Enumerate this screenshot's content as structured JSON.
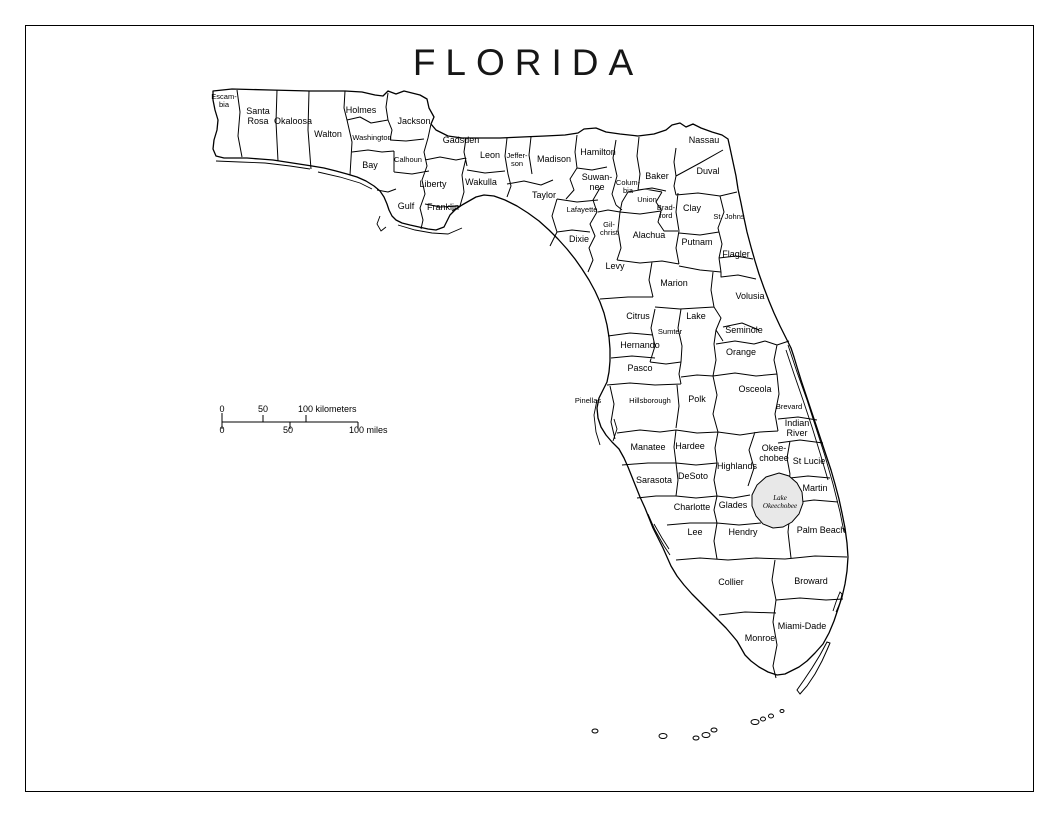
{
  "title": "FLORIDA",
  "scale_bar": {
    "km0": "0",
    "km50": "50",
    "km100": "100 kilometers",
    "mi0": "0",
    "mi50": "50",
    "mi100": "100 miles"
  },
  "lake": {
    "line1": "Lake",
    "line2": "Okeechobee"
  },
  "counties": [
    {
      "name": "Escambia",
      "lines": [
        "Escam-",
        "bia"
      ],
      "x": 224,
      "y": 101,
      "size": "s"
    },
    {
      "name": "Santa Rosa",
      "lines": [
        "Santa",
        "Rosa"
      ],
      "x": 258,
      "y": 117,
      "size": "m"
    },
    {
      "name": "Okaloosa",
      "x": 293,
      "y": 122,
      "size": "m"
    },
    {
      "name": "Walton",
      "x": 328,
      "y": 135,
      "size": "m"
    },
    {
      "name": "Holmes",
      "x": 361,
      "y": 111,
      "size": "m"
    },
    {
      "name": "Washington",
      "x": 372,
      "y": 138,
      "size": "s"
    },
    {
      "name": "Jackson",
      "x": 414,
      "y": 122,
      "size": "m"
    },
    {
      "name": "Bay",
      "x": 370,
      "y": 166,
      "size": "m"
    },
    {
      "name": "Calhoun",
      "x": 408,
      "y": 160,
      "size": "s"
    },
    {
      "name": "Gadsden",
      "x": 461,
      "y": 141,
      "size": "m"
    },
    {
      "name": "Liberty",
      "x": 433,
      "y": 185,
      "size": "m"
    },
    {
      "name": "Gulf",
      "x": 406,
      "y": 207,
      "size": "m"
    },
    {
      "name": "Franklin",
      "x": 443,
      "y": 208,
      "size": "m"
    },
    {
      "name": "Wakulla",
      "x": 481,
      "y": 183,
      "size": "m"
    },
    {
      "name": "Leon",
      "x": 490,
      "y": 156,
      "size": "m"
    },
    {
      "name": "Jefferson",
      "lines": [
        "Jeffer-",
        "son"
      ],
      "x": 517,
      "y": 160,
      "size": "s"
    },
    {
      "name": "Madison",
      "x": 554,
      "y": 160,
      "size": "m"
    },
    {
      "name": "Hamilton",
      "x": 598,
      "y": 153,
      "size": "m"
    },
    {
      "name": "Suwannee",
      "lines": [
        "Suwan-",
        "nee"
      ],
      "x": 597,
      "y": 183,
      "size": "m"
    },
    {
      "name": "Columbia",
      "lines": [
        "Colum-",
        "bia"
      ],
      "x": 628,
      "y": 187,
      "size": "s"
    },
    {
      "name": "Baker",
      "x": 657,
      "y": 177,
      "size": "m"
    },
    {
      "name": "Nassau",
      "x": 704,
      "y": 141,
      "size": "m"
    },
    {
      "name": "Duval",
      "x": 708,
      "y": 172,
      "size": "m"
    },
    {
      "name": "Taylor",
      "x": 544,
      "y": 196,
      "size": "m"
    },
    {
      "name": "Lafayette",
      "x": 582,
      "y": 210,
      "size": "s"
    },
    {
      "name": "Union",
      "x": 647,
      "y": 200,
      "size": "s"
    },
    {
      "name": "Bradford",
      "lines": [
        "Brad-",
        "ford"
      ],
      "x": 666,
      "y": 212,
      "size": "s"
    },
    {
      "name": "Clay",
      "x": 692,
      "y": 209,
      "size": "m"
    },
    {
      "name": "St. Johns",
      "x": 729,
      "y": 217,
      "size": "s"
    },
    {
      "name": "Dixie",
      "x": 579,
      "y": 240,
      "size": "m"
    },
    {
      "name": "Gilchrist",
      "lines": [
        "Gil-",
        "christ"
      ],
      "x": 609,
      "y": 229,
      "size": "s"
    },
    {
      "name": "Alachua",
      "x": 649,
      "y": 236,
      "size": "m"
    },
    {
      "name": "Putnam",
      "x": 697,
      "y": 243,
      "size": "m"
    },
    {
      "name": "Flagler",
      "x": 736,
      "y": 255,
      "size": "m"
    },
    {
      "name": "Levy",
      "x": 615,
      "y": 267,
      "size": "m"
    },
    {
      "name": "Marion",
      "x": 674,
      "y": 284,
      "size": "m"
    },
    {
      "name": "Volusia",
      "x": 750,
      "y": 297,
      "size": "m"
    },
    {
      "name": "Citrus",
      "x": 638,
      "y": 317,
      "size": "m"
    },
    {
      "name": "Lake",
      "x": 696,
      "y": 317,
      "size": "m"
    },
    {
      "name": "Sumter",
      "x": 670,
      "y": 332,
      "size": "s"
    },
    {
      "name": "Seminole",
      "x": 744,
      "y": 331,
      "size": "m"
    },
    {
      "name": "Hernando",
      "x": 640,
      "y": 346,
      "size": "m"
    },
    {
      "name": "Orange",
      "x": 741,
      "y": 353,
      "size": "m"
    },
    {
      "name": "Pasco",
      "x": 640,
      "y": 369,
      "size": "m"
    },
    {
      "name": "Osceola",
      "x": 755,
      "y": 390,
      "size": "m"
    },
    {
      "name": "Pinellas",
      "x": 588,
      "y": 401,
      "size": "s"
    },
    {
      "name": "Hillsborough",
      "x": 650,
      "y": 401,
      "size": "s"
    },
    {
      "name": "Polk",
      "x": 697,
      "y": 400,
      "size": "m"
    },
    {
      "name": "Brevard",
      "x": 789,
      "y": 407,
      "size": "s"
    },
    {
      "name": "Indian River",
      "lines": [
        "Indian",
        "River"
      ],
      "x": 797,
      "y": 429,
      "size": "m"
    },
    {
      "name": "Manatee",
      "x": 648,
      "y": 448,
      "size": "m"
    },
    {
      "name": "Hardee",
      "x": 690,
      "y": 447,
      "size": "m"
    },
    {
      "name": "Okeechobee",
      "lines": [
        "Okee-",
        "chobee"
      ],
      "x": 774,
      "y": 454,
      "size": "m"
    },
    {
      "name": "St Lucie",
      "x": 809,
      "y": 462,
      "size": "m"
    },
    {
      "name": "Sarasota",
      "x": 654,
      "y": 481,
      "size": "m"
    },
    {
      "name": "DeSoto",
      "x": 693,
      "y": 477,
      "size": "m"
    },
    {
      "name": "Highlands",
      "x": 737,
      "y": 467,
      "size": "m"
    },
    {
      "name": "Martin",
      "x": 815,
      "y": 489,
      "size": "m"
    },
    {
      "name": "Charlotte",
      "x": 692,
      "y": 508,
      "size": "m"
    },
    {
      "name": "Glades",
      "x": 733,
      "y": 506,
      "size": "m"
    },
    {
      "name": "Lee",
      "x": 695,
      "y": 533,
      "size": "m"
    },
    {
      "name": "Hendry",
      "x": 743,
      "y": 533,
      "size": "m"
    },
    {
      "name": "Palm Beach",
      "x": 821,
      "y": 531,
      "size": "m"
    },
    {
      "name": "Collier",
      "x": 731,
      "y": 583,
      "size": "m"
    },
    {
      "name": "Broward",
      "x": 811,
      "y": 582,
      "size": "m"
    },
    {
      "name": "Monroe",
      "x": 760,
      "y": 639,
      "size": "m"
    },
    {
      "name": "Miami-Dade",
      "x": 802,
      "y": 627,
      "size": "m"
    }
  ]
}
